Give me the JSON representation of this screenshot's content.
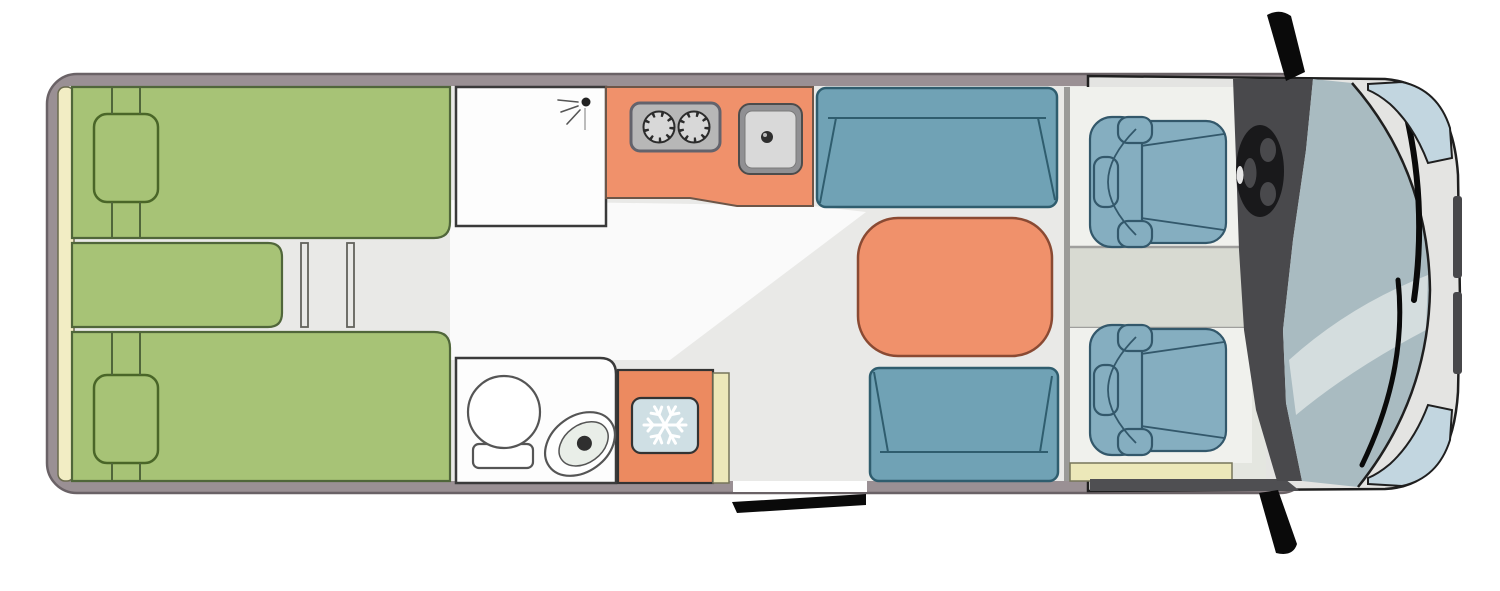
{
  "title": "Motorhome floor plan - top view",
  "floorplan": {
    "type": "campervan-top-view",
    "zones": [
      {
        "name": "rear-bedroom",
        "items": [
          "headboard",
          "single-bed-top",
          "single-bed-bottom",
          "bed-connector-section",
          "pillow-top",
          "pillow-bottom",
          "bed-steps"
        ]
      },
      {
        "name": "washroom",
        "items": [
          "shower-cabin",
          "shower-head-icon",
          "bathroom",
          "washbasin",
          "toilet"
        ]
      },
      {
        "name": "kitchen",
        "items": [
          "kitchen-counter",
          "two-burner-stove",
          "sink",
          "fridge",
          "snowflake-icon",
          "wardrobe-strip"
        ]
      },
      {
        "name": "dinette",
        "items": [
          "bench-front",
          "table",
          "bench-rear"
        ]
      },
      {
        "name": "entrance",
        "items": [
          "entry-door",
          "entry-step"
        ]
      },
      {
        "name": "cab",
        "items": [
          "driver-seat",
          "passenger-seat",
          "cab-aisle",
          "dashboard",
          "steering-wheel",
          "windshield",
          "wiper-left",
          "wiper-right",
          "hood",
          "headlight-top",
          "headlight-bottom",
          "front-grille",
          "side-mirror-top",
          "side-mirror-bottom"
        ]
      }
    ]
  },
  "colors": {
    "wall": "#9a9094",
    "wall_outline": "#6a6266",
    "floor": "#e9e9e7",
    "corridor": "#fafafa",
    "headboard": "#f2edc4",
    "headboard_outline": "#6b6b4e",
    "bed": "#a7c376",
    "bed_outline": "#50663a",
    "pillow_outline": "#4a6628",
    "step_lines": "#62625d",
    "room_white": "#fdfdfd",
    "room_outline": "#3a3a3a",
    "counter": "#f0916b",
    "counter_outline": "#6d5648",
    "stove": "#b7b7b7",
    "stove_outline": "#63636c",
    "burner": "#d8d8d8",
    "burner_tick": "#2c2c2c",
    "sink_outer": "#909093",
    "sink_inner": "#d9d9d9",
    "drain": "#2f2f2f",
    "sofa": "#70a2b5",
    "sofa_outline": "#2f5d6e",
    "table": "#f0916b",
    "table_outline": "#8a4a33",
    "fixture_outline": "#555555",
    "toilet_inner": "#e9eee8",
    "fridge": "#ec8a60",
    "fridge_panel": "#cfdfe4",
    "snowflake": "#ffffff",
    "step_yellow": "#ece8b9",
    "step_yellow_outline": "#76765a",
    "cab_floor": "#e4e6e0",
    "cab_divider": "#9a9a98",
    "platform": "#f0f1ed",
    "aisle": "#d8dad2",
    "aisle_line": "#9f9f9d",
    "seat": "#85aec0",
    "seat_outline": "#33586b",
    "dashboard": "#49494c",
    "wheel": "#19191b",
    "wheel_highlight": "#e6e6e6",
    "windshield": "#a9bbc1",
    "streak": "#dce3e3",
    "body": "#e4e4e2",
    "body_outline": "#1f1f1f",
    "headlight": "#c2d6e0",
    "grille": "#47474a",
    "mirror": "#0a0a0a"
  }
}
